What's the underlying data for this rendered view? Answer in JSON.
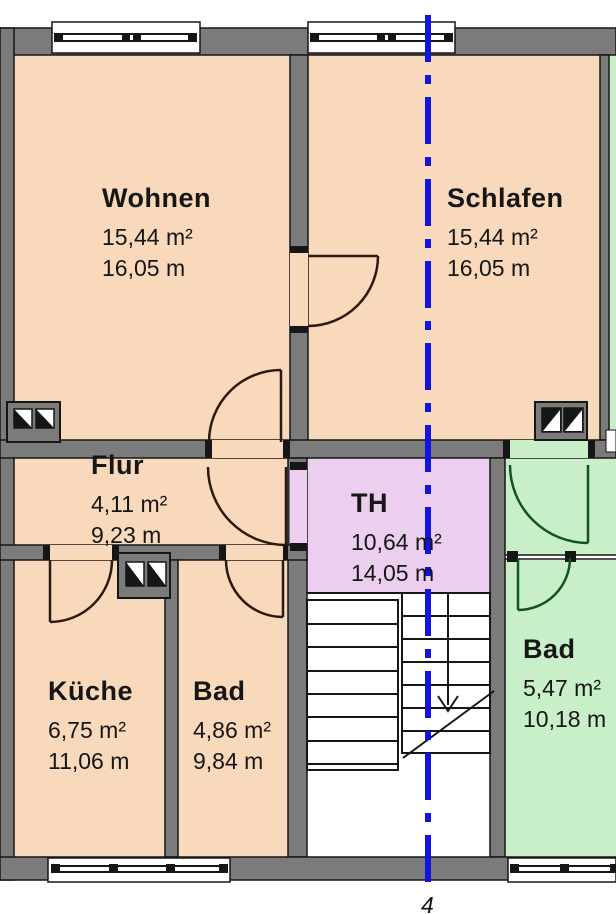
{
  "rooms": [
    {
      "id": "wohnen",
      "name": "Wohnen",
      "area": "15,44 m²",
      "perimeter": "16,05 m"
    },
    {
      "id": "schlafen",
      "name": "Schlafen",
      "area": "15,44 m²",
      "perimeter": "16,05 m"
    },
    {
      "id": "flur",
      "name": "Flur",
      "area": "4,11 m²",
      "perimeter": "9,23 m"
    },
    {
      "id": "th",
      "name": "TH",
      "area": "10,64 m²",
      "perimeter": "14,05 m"
    },
    {
      "id": "kueche",
      "name": "Küche",
      "area": "6,75 m²",
      "perimeter": "11,06 m"
    },
    {
      "id": "bad",
      "name": "Bad",
      "area": "4,86 m²",
      "perimeter": "9,84 m"
    },
    {
      "id": "bad2",
      "name": "Bad",
      "area": "5,47 m²",
      "perimeter": "10,18 m"
    }
  ],
  "section_marker": {
    "label": "4"
  },
  "colors": {
    "room_fill": "#f8d9bc",
    "stairhall_fill": "#eccfef",
    "neighbor_fill": "#c9efc8",
    "wall_fill": "#7b7b7b",
    "outline": "#161616",
    "door_arc": "#2b1a10",
    "neighbor_door_arc": "#14541f",
    "section_line": "#1414e0"
  }
}
